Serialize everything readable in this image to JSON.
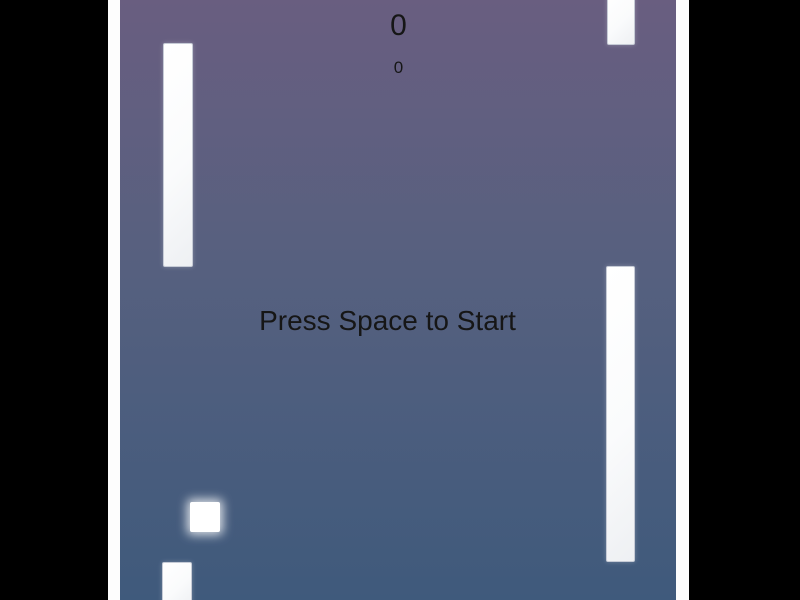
{
  "window": {
    "width": 800,
    "height": 600
  },
  "hud": {
    "score_primary": "0",
    "score_secondary": "0",
    "start_prompt": "Press Space to Start"
  },
  "colors": {
    "letterbox": "#000000",
    "background_top": "#695e80",
    "background_bottom": "#3f5a7c",
    "wall": "#fdfdfd",
    "obstacle_fill": "#ffffff",
    "obstacle_border": "#c6cbd6",
    "player": "#ffffff",
    "text": "#161616"
  },
  "entities": {
    "player": {
      "x": 82,
      "y": 502,
      "w": 30,
      "h": 30
    },
    "obstacles": [
      {
        "name": "pipe-left-top",
        "x": 55,
        "y": 43,
        "w": 30,
        "h": 224
      },
      {
        "name": "pipe-right-top",
        "x": 499,
        "y": -8,
        "w": 28,
        "h": 53
      },
      {
        "name": "pipe-right-middle",
        "x": 498,
        "y": 266,
        "w": 29,
        "h": 296
      },
      {
        "name": "pipe-left-bottom",
        "x": 54,
        "y": 562,
        "w": 30,
        "h": 46
      }
    ]
  }
}
